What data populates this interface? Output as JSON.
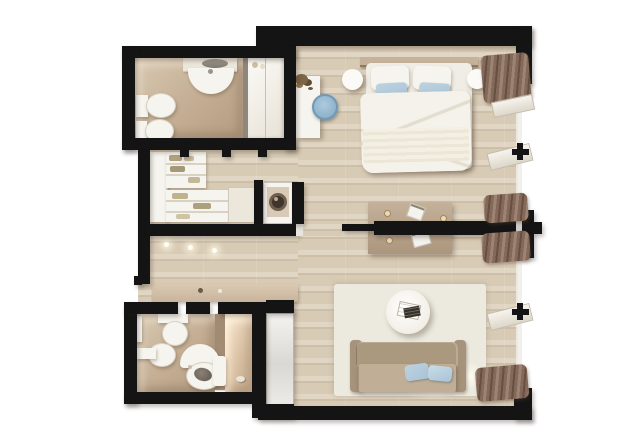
{
  "title": "3d-top-view-studio-apartment-floor-plan",
  "palette": {
    "wall": "#141414",
    "wall_cap": "#e8e5df",
    "wood": "#d8cbb5",
    "wood_dark": "#cec0a8",
    "wood_light": "#e1d6c3",
    "bath_floor": "#c3ad93",
    "bath_floor_light": "#d8c8b2",
    "partition_tan": "#a28b73",
    "fixture_white": "#f6f4ee",
    "cream": "#ece7db",
    "divider_gray": "#8f877b",
    "sofa_back": "#ab997f",
    "sofa_seat": "#c0ae96",
    "pillow_blue": "#a8c3d6",
    "pillow_blue_light": "#bdd2e0",
    "curtain": "#84695a",
    "curtain_dark": "#66503f",
    "curtain_light": "#9d8372",
    "table_tan": "#b9a58d",
    "chair_blue": "#8fb3cb",
    "chair_blue_light": "#accadd",
    "rug": "#eceadf",
    "lamp": "#fbfaf7",
    "headboard": "#c4b29b",
    "washer_door": "#3f352b",
    "washer_ring": "#6f5f4e",
    "shelf_line": "#d8d2c4",
    "clothes_olive": "#b0a17c",
    "clothes_tan": "#cdc2a0",
    "metal_gray": "#9b948a",
    "glass_door_light": "#f4f3f0",
    "glass_door_dark": "#d9d8d4"
  },
  "scene": {
    "view": "top-down 3d render, white background, black cut walls",
    "rooms": [
      {
        "name": "bathroom-top-left",
        "floor": "tan tile",
        "features": [
          "vanity-counter-sink",
          "toilet",
          "bidet",
          "mirrored-wardrobe-cabinet",
          "shelf-items"
        ]
      },
      {
        "name": "walk-in-closet",
        "floor": "wood",
        "features": [
          "wardrobe-column",
          "shelving-unit-top",
          "shelving-unit-bottom",
          "drawer-counter",
          "washing-machine-niche"
        ]
      },
      {
        "name": "entry-corridor",
        "floor": "wood",
        "features": [
          "console-cabinet",
          "three-ceiling-spotlights",
          "entry-door-gap-left-wall"
        ]
      },
      {
        "name": "bathroom-bottom-left",
        "floor": "tan tile",
        "features": [
          "wall-hung-toilet",
          "bidet",
          "round-basin-vanity",
          "towel-shelf",
          "shower-partition",
          "shower-area",
          "sliding-glass-door"
        ]
      },
      {
        "name": "bedroom-top-right",
        "floor": "wood",
        "features": [
          "double-bed-white-duvet",
          "headboard",
          "two-white-pillows",
          "two-blue-accent-pillows",
          "round-bedside-lamp-left",
          "round-bedside-lamp-right",
          "white-desk",
          "desk-plant",
          "round-blue-chair",
          "curtain-bunch"
        ]
      },
      {
        "name": "table-nook-center",
        "floor": "wood",
        "features": [
          "tan-table",
          "crumpled-napkins",
          "tea-light-candles",
          "black-partition-wall-through-table"
        ]
      },
      {
        "name": "living-area-bottom-right",
        "floor": "wood",
        "features": [
          "light-area-rug",
          "tan-sofa",
          "two-blue-sofa-pillows",
          "round-white-coffee-table",
          "magazines",
          "floor-glow-lights",
          "curtain-bunch"
        ]
      }
    ],
    "windows": {
      "side": "right",
      "style": "full-height openings in black wall",
      "details": [
        "transom-bar-with-black-mullion-upper",
        "transom-bar-with-black-mullion-lower",
        "curtain-bunches-top-middle-bottom",
        "partition-wall-end-cap-at-window"
      ]
    }
  }
}
